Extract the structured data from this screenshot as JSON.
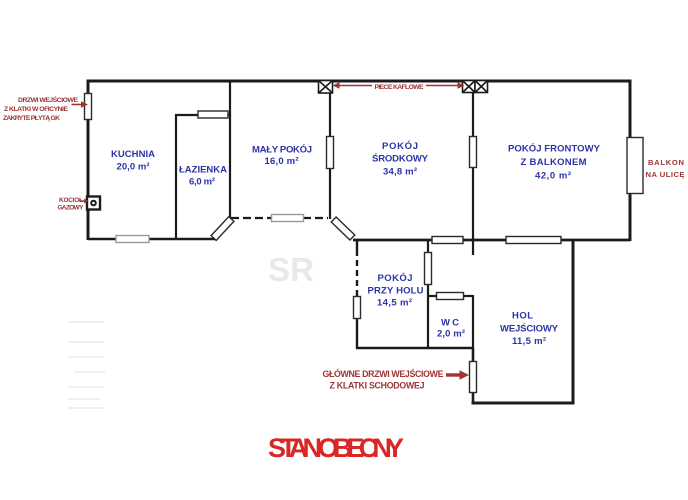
{
  "title": "STAN OBECNY",
  "watermark": "SR",
  "rooms": [
    {
      "name": "KUCHNIA",
      "area": "20,0 m²"
    },
    {
      "name": "ŁAZIENKA",
      "area": "6,0 m²"
    },
    {
      "name": "MAŁY POKÓJ",
      "area": "16,0 m²"
    },
    {
      "name": "POKÓJ",
      "name2": "ŚRODKOWY",
      "area": "34,8 m²"
    },
    {
      "name": "POKÓJ FRONTOWY",
      "name2": "Z BALKONEM",
      "area": "42,0 m²"
    },
    {
      "name": "POKÓJ",
      "name2": "PRZY HOLU",
      "area": "14,5 m²"
    },
    {
      "name": "WC",
      "area": "2,0 m²"
    },
    {
      "name": "HOL",
      "name2": "WEJŚCIOWY",
      "area": "11,5 m²"
    }
  ],
  "annotations": {
    "oficyna_line1": "DRZWI WEJŚCIOWE",
    "oficyna_line2": "Z KLATKI W OFICYNIE",
    "oficyna_line3": "ZAKRYTE PŁYTĄ GK",
    "kociol_line1": "KOCIOŁ",
    "kociol_line2": "GAZOWY",
    "piece_kaflowe": "PIECE KAFLOWE",
    "balkon_line1": "BALKON",
    "balkon_line2": "NA ULICĘ",
    "entrance_line1": "GŁÓWNE DRZWI WEJŚCIOWE",
    "entrance_line2": "Z KLATKI SCHODOWEJ"
  },
  "colors": {
    "wall": "#1b1b1b",
    "room_label": "#2b34a6",
    "annotation_red": "#9e3434",
    "title_red": "#d92626"
  }
}
